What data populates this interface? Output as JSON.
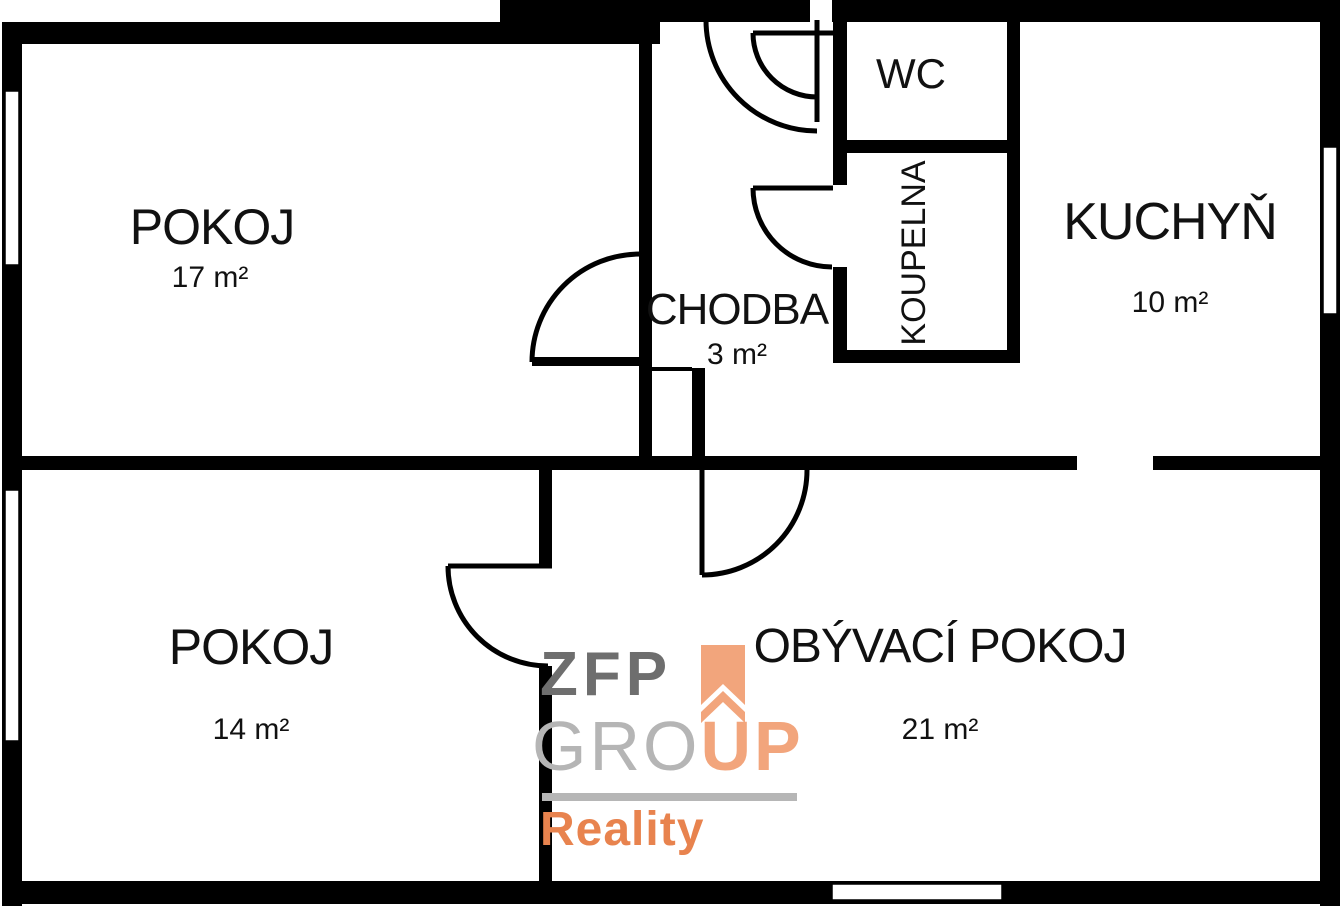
{
  "plan": {
    "type": "apartment-floor-plan",
    "background": "#ffffff",
    "wall_color": "#000000"
  },
  "rooms": {
    "pokoj1": {
      "name": "POKOJ",
      "area": "17 m²"
    },
    "chodba": {
      "name": "CHODBA",
      "area": "3 m²"
    },
    "wc": {
      "name": "WC"
    },
    "koupelna": {
      "name": "KOUPELNA"
    },
    "kuchyn": {
      "name": "KUCHYŇ",
      "area": "10 m²"
    },
    "pokoj2": {
      "name": "POKOJ",
      "area": "14 m²"
    },
    "obyvaci": {
      "name": "OBÝVACÍ POKOJ",
      "area": "21 m²"
    }
  },
  "brand": {
    "zfp": "ZFP",
    "gro": "GRO",
    "up": "UP",
    "reality": "Reality",
    "colors": {
      "zfp_dark_gray": "#6e6e6e",
      "group_light_gray": "#b5b5b5",
      "up_orange": "#f2a57c",
      "reality_orange": "#e8834e"
    }
  }
}
